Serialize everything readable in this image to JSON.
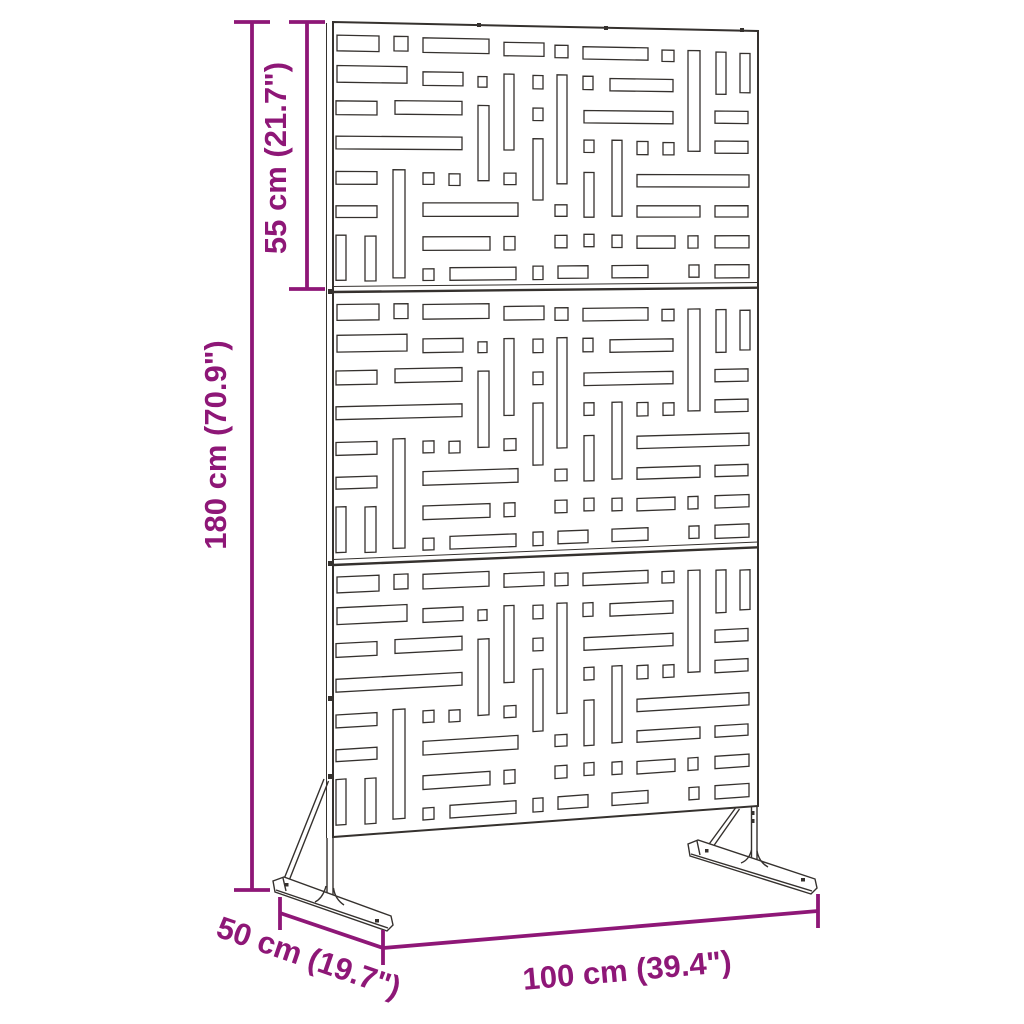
{
  "labels": {
    "height": "180 cm (70.9\")",
    "section_height": "55 cm (21.7\")",
    "width": "100 cm (39.4\")",
    "depth": "50 cm (19.7\")"
  },
  "colors": {
    "dimension_annotation": "#8e1777",
    "drawing_outline": "#35312e",
    "background": "#ffffff"
  },
  "screen": {
    "panel_count": 3,
    "slots_per_panel": 60,
    "panel_slots": [
      [
        4,
        10,
        42,
        16
      ],
      [
        61,
        10,
        14,
        15
      ],
      [
        90,
        11,
        66,
        15
      ],
      [
        171,
        14,
        40,
        14
      ],
      [
        222,
        16,
        13,
        13
      ],
      [
        250,
        17,
        65,
        13
      ],
      [
        329,
        19,
        12,
        12
      ],
      [
        355,
        19,
        12,
        107
      ],
      [
        383,
        20,
        10,
        45
      ],
      [
        407,
        21,
        10,
        42
      ],
      [
        4,
        41,
        70,
        17
      ],
      [
        90,
        46,
        40,
        14
      ],
      [
        145,
        50,
        9,
        11
      ],
      [
        171,
        47,
        10,
        79
      ],
      [
        200,
        48,
        10,
        14
      ],
      [
        224,
        47,
        10,
        114
      ],
      [
        250,
        48,
        10,
        14
      ],
      [
        277,
        50,
        63,
        13
      ],
      [
        3,
        77,
        41,
        14
      ],
      [
        62,
        76,
        67,
        14
      ],
      [
        145,
        80,
        11,
        78
      ],
      [
        200,
        82,
        10,
        13
      ],
      [
        251,
        84,
        89,
        13
      ],
      [
        382,
        83,
        33,
        13
      ],
      [
        3,
        113,
        126,
        13
      ],
      [
        200,
        114,
        10,
        64
      ],
      [
        251,
        115,
        10,
        13
      ],
      [
        279,
        115,
        10,
        80
      ],
      [
        304,
        116,
        11,
        14
      ],
      [
        330,
        117,
        11,
        13
      ],
      [
        382,
        115,
        33,
        13
      ],
      [
        3,
        149,
        41,
        13
      ],
      [
        60,
        147,
        12,
        111
      ],
      [
        90,
        150,
        11,
        12
      ],
      [
        116,
        151,
        11,
        12
      ],
      [
        171,
        150,
        12,
        12
      ],
      [
        251,
        149,
        10,
        47
      ],
      [
        304,
        151,
        112,
        13
      ],
      [
        3,
        184,
        41,
        12
      ],
      [
        90,
        181,
        95,
        14
      ],
      [
        222,
        183,
        12,
        12
      ],
      [
        304,
        184,
        63,
        12
      ],
      [
        382,
        184,
        33,
        12
      ],
      [
        3,
        214,
        10,
        46
      ],
      [
        32,
        215,
        11,
        46
      ],
      [
        90,
        216,
        67,
        14
      ],
      [
        171,
        216,
        11,
        14
      ],
      [
        222,
        215,
        12,
        13
      ],
      [
        251,
        214,
        10,
        13
      ],
      [
        279,
        215,
        10,
        13
      ],
      [
        304,
        216,
        38,
        13
      ],
      [
        355,
        216,
        10,
        13
      ],
      [
        382,
        216,
        34,
        13
      ],
      [
        90,
        249,
        11,
        12
      ],
      [
        117,
        248,
        66,
        13
      ],
      [
        200,
        247,
        10,
        14
      ],
      [
        225,
        247,
        30,
        13
      ],
      [
        279,
        247,
        36,
        13
      ],
      [
        356,
        247,
        10,
        13
      ],
      [
        382,
        247,
        34,
        14
      ]
    ]
  }
}
